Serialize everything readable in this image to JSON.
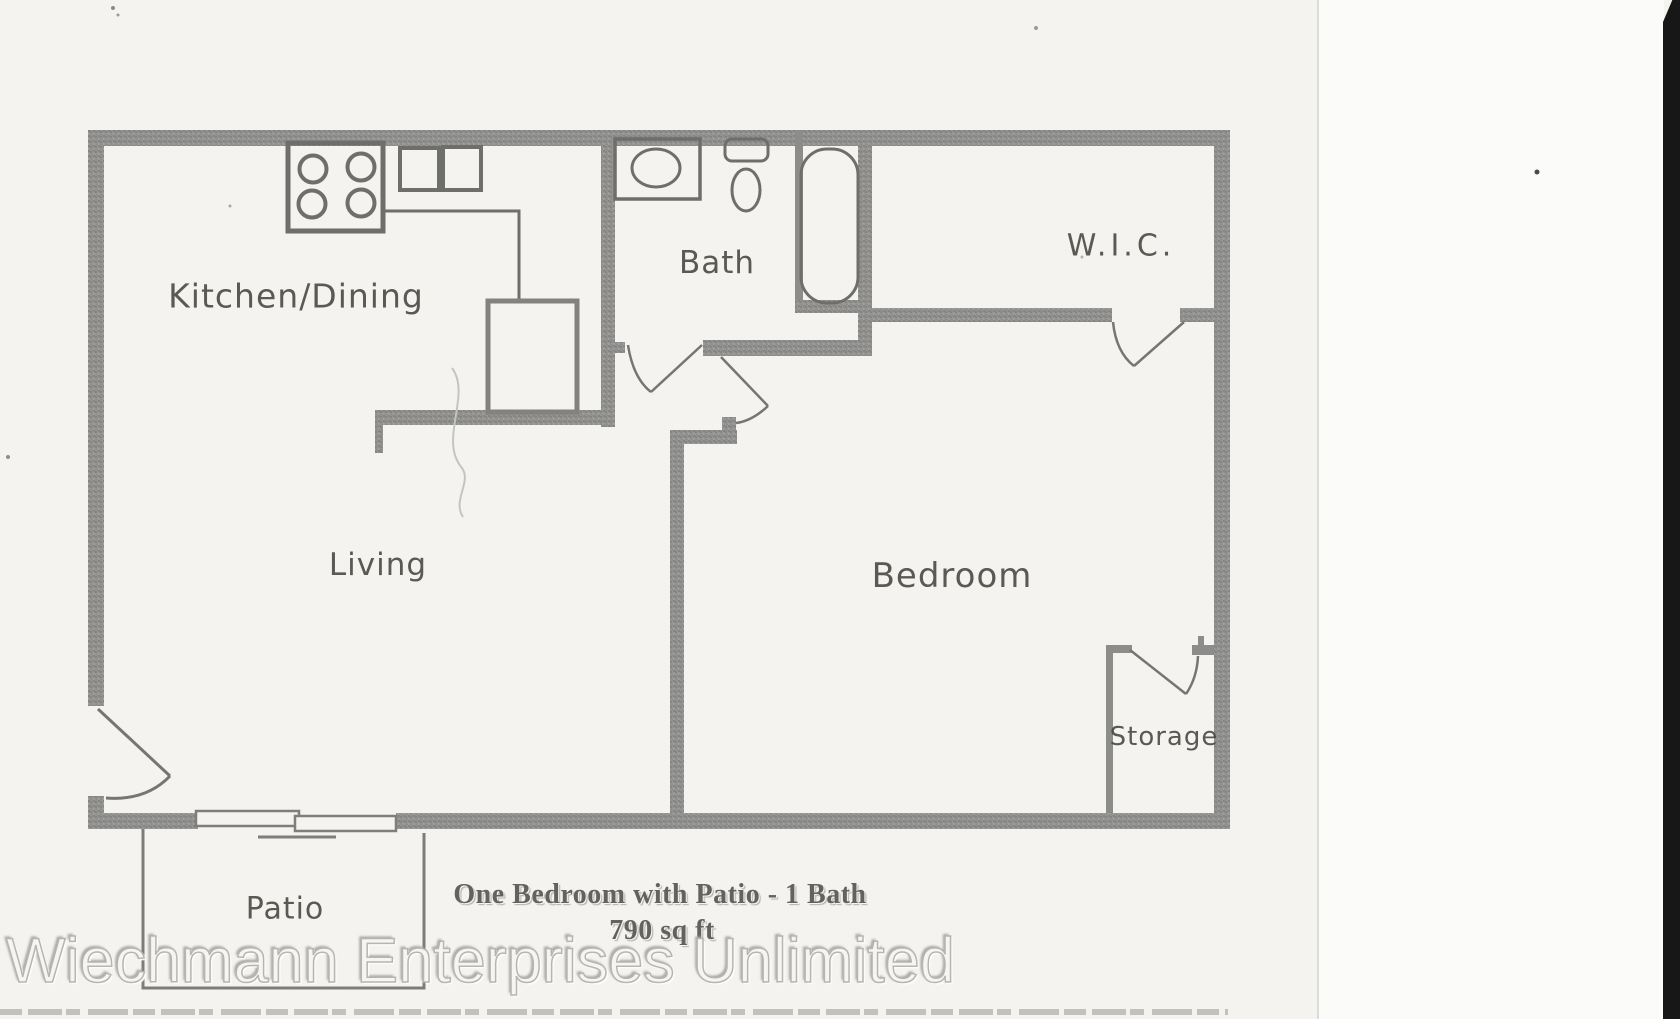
{
  "floorplan": {
    "rooms": {
      "kitchen_dining": "Kitchen/Dining",
      "bath": "Bath",
      "wic": "W.I.C.",
      "living": "Living",
      "bedroom": "Bedroom",
      "storage": "Storage",
      "patio": "Patio"
    },
    "caption": {
      "title": "One Bedroom with Patio - 1 Bath",
      "area": "790 sq ft"
    },
    "watermark": "Wiechmann Enterprises Unlimited",
    "colors": {
      "wall_gray": "#8f8f8f",
      "fixture_line": "#6e6e6e",
      "door_line": "#757575",
      "label_text": "#454540",
      "caption_text": "#63625e",
      "watermark_outline": "#b6b5b1",
      "scanner_strip": "#171717",
      "paper": "#f4f3f0"
    }
  }
}
